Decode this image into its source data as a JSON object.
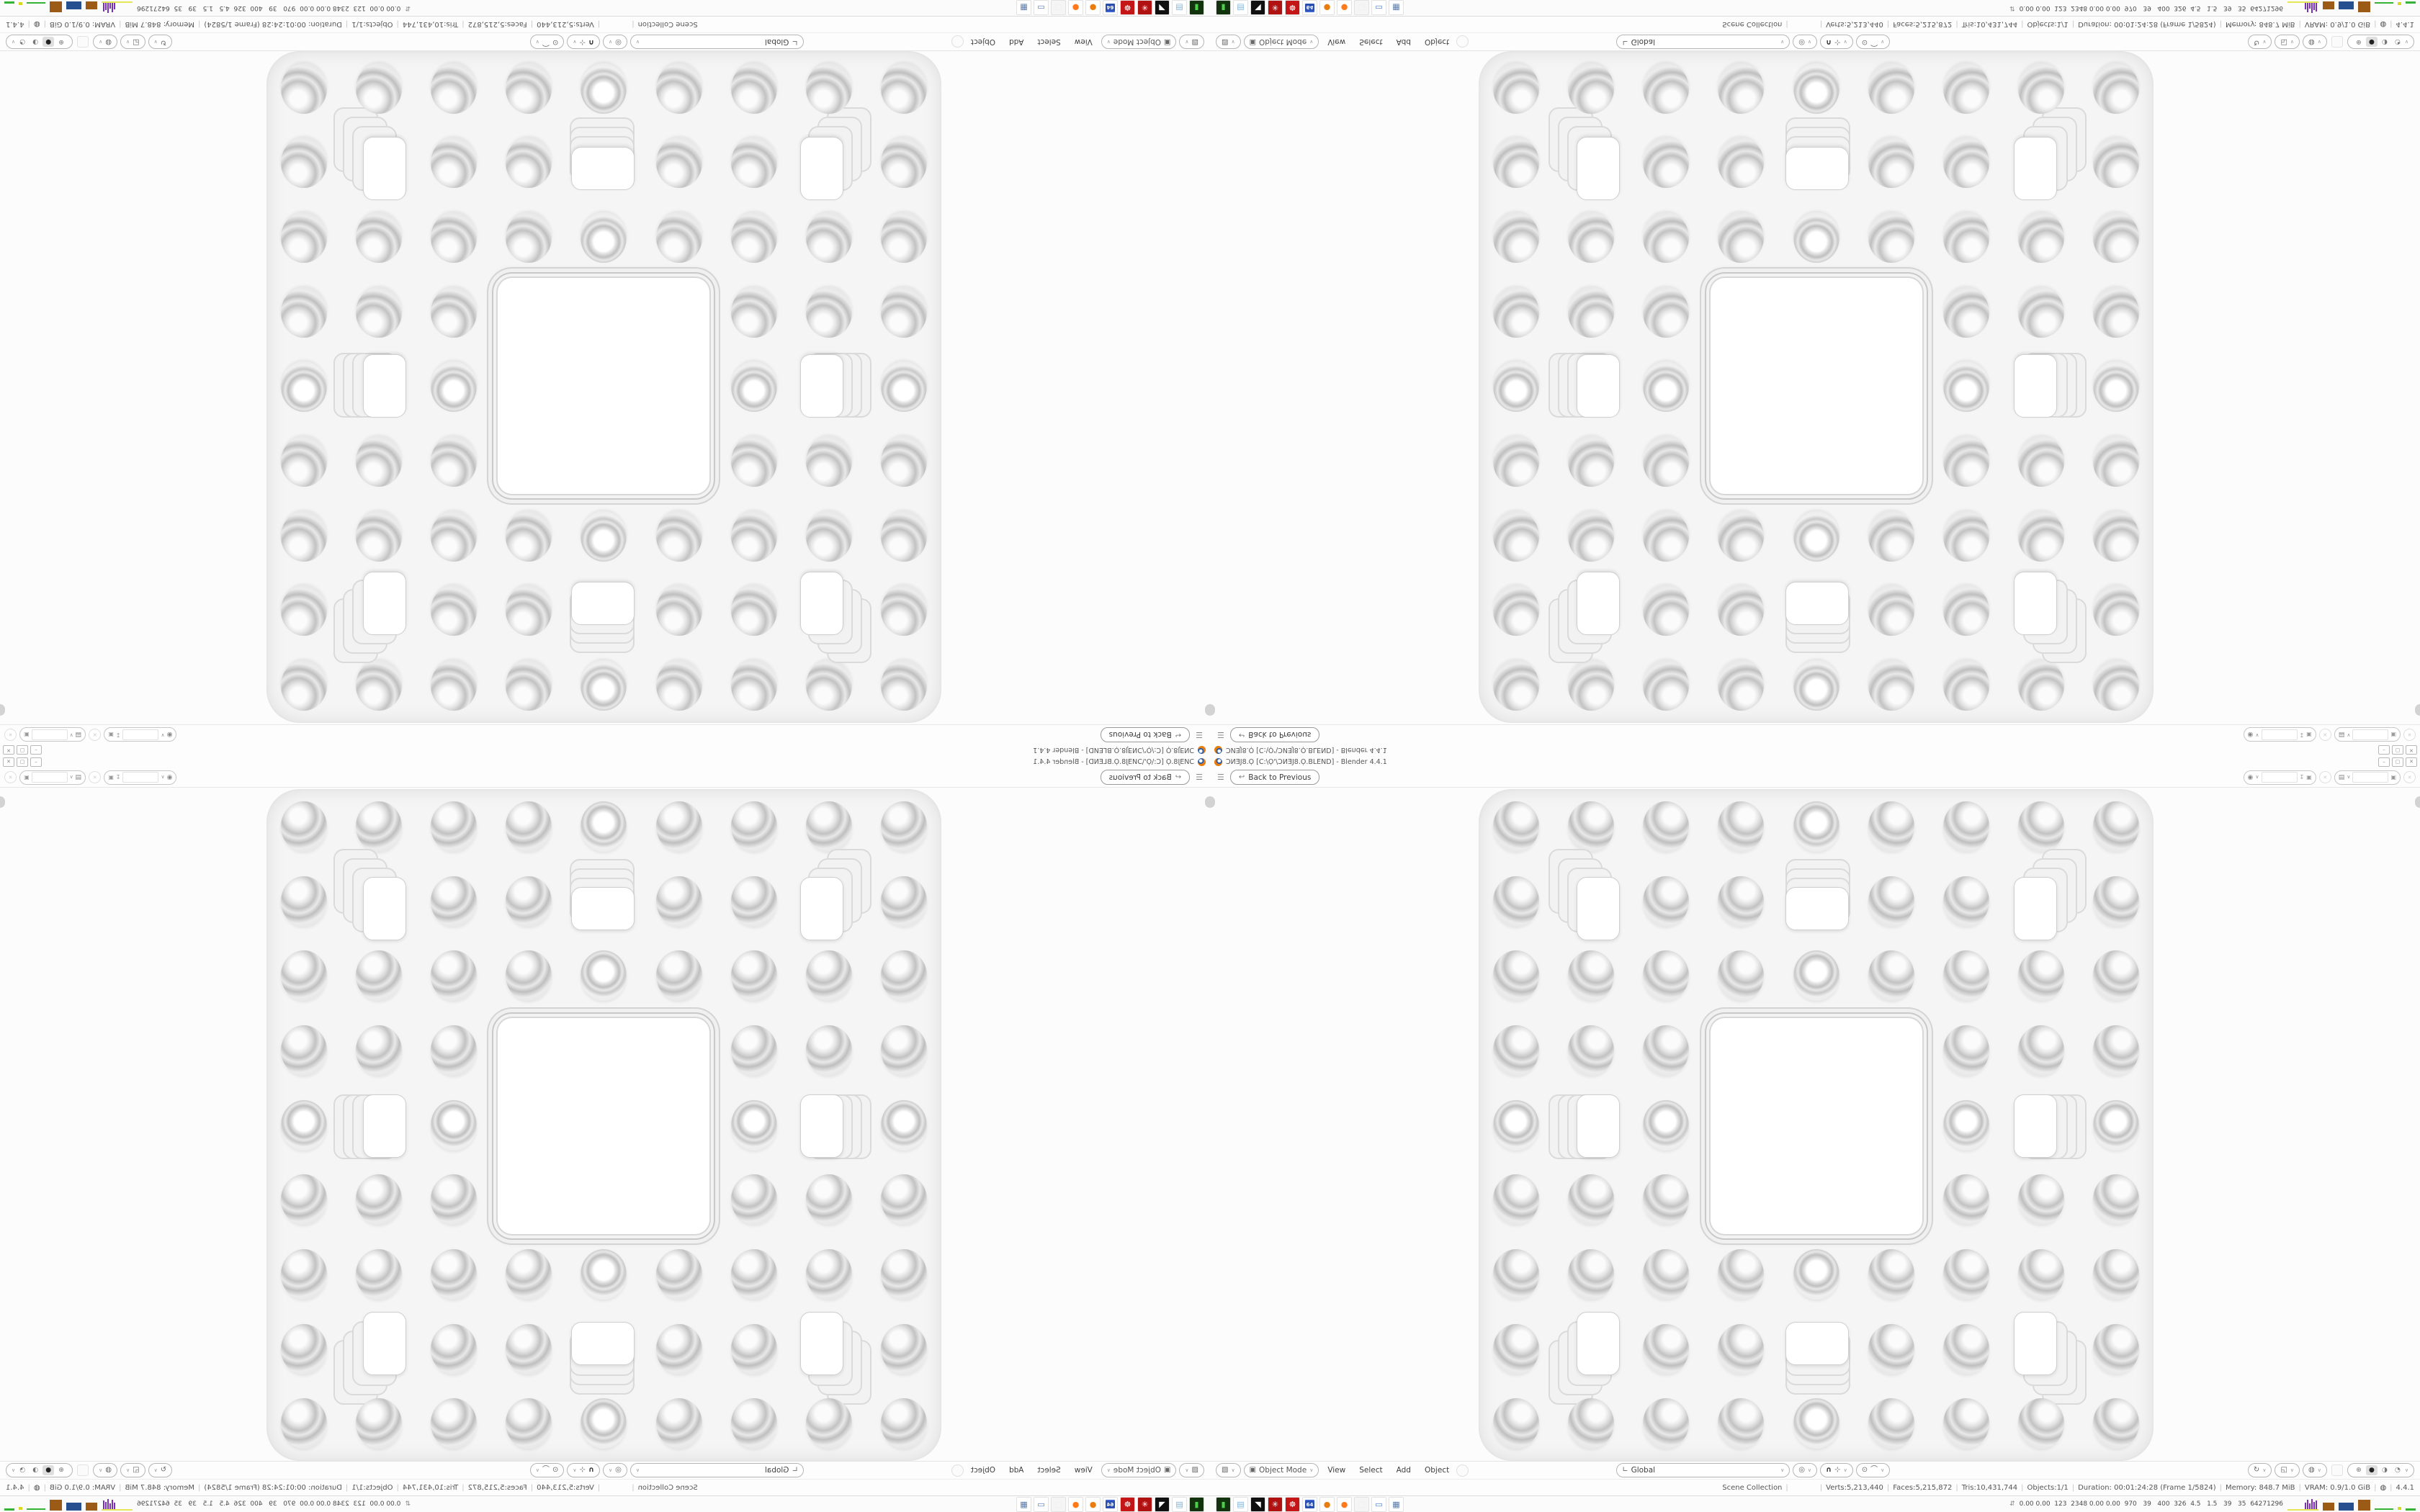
{
  "desktop": {
    "titlebar": {
      "title": "ƆИƎJ8.Ọ [C:\\Ọ'\\ƆИƎJ8.Ọ.BLEND] - Blender 4.4.1",
      "minimize_glyph": "–",
      "restore_glyph": "▢",
      "close_glyph": "✕"
    },
    "topbar": {
      "menu_glyph": "☰",
      "back_icon_glyph": "↩",
      "back_button": "Back to Previous",
      "scene_selector": {
        "icon_glyph": "◉",
        "chevron": "∨",
        "value": "",
        "pin_glyph": "↧",
        "copy_glyph": "▣",
        "clear_glyph": "✕"
      },
      "view_layer_selector": {
        "icon_glyph": "▤",
        "chevron": "∨",
        "value": "",
        "copy_glyph": "▣",
        "clear_glyph": "✕"
      }
    },
    "viewport_header": {
      "editor_icon_glyph": "▧",
      "mode": {
        "icon_glyph": "▣",
        "label": "Object Mode",
        "chevron": "∨"
      },
      "menus": [
        "View",
        "Select",
        "Add",
        "Object"
      ],
      "orientation": {
        "icon_glyph": "∟",
        "label": "Global",
        "chevron": "∨"
      },
      "snap_circle_glyph": "◎",
      "magnet_glyph": "∩",
      "snap_target_glyph": "⊹",
      "prop_edit_glyph": "⊙",
      "falloff_glyph": "⌒",
      "gizmo_glyph": "↻",
      "overlays_glyph": "◱",
      "xray_glyph": "◍",
      "chevron": "∨",
      "shading_modes": [
        {
          "name": "wireframe",
          "glyph": "⊕",
          "active": false
        },
        {
          "name": "solid",
          "glyph": "●",
          "active": true
        },
        {
          "name": "material-preview",
          "glyph": "◑",
          "active": false
        },
        {
          "name": "rendered",
          "glyph": "◔",
          "active": false
        }
      ]
    },
    "statusbar": {
      "segments": [
        "Scene Collection",
        "",
        "Verts:5,213,440",
        "Faces:5,215,872",
        "Tris:10,431,744",
        "Objects:1/1",
        "Duration: 00:01:24:28 (Frame 1/5824)",
        "Memory: 848.7 MiB",
        "VRAM: 0.9/1.0 GiB"
      ],
      "globe_glyph": "◍",
      "version": "4.4.1"
    },
    "taskbar": {
      "icons": [
        {
          "name": "system-monitor-icon",
          "bg": "#13330f",
          "fg": "#4cd04c",
          "glyph": "▮"
        },
        {
          "name": "notepad-icon",
          "bg": "#ffffff",
          "fg": "#7fb2d9",
          "glyph": "▤"
        },
        {
          "name": "media-player-icon",
          "bg": "#101010",
          "fg": "#ffffff",
          "glyph": "◥"
        },
        {
          "name": "red-mandala-icon",
          "bg": "#b01212",
          "fg": "#ffffff",
          "glyph": "✳"
        },
        {
          "name": "red-gear-icon",
          "bg": "#c41616",
          "fg": "#ffffff",
          "glyph": "☸"
        },
        {
          "name": "floppy-64-icon",
          "bg": "#ffffff",
          "fg": "#ffffff",
          "glyph": "64",
          "chip": true
        },
        {
          "name": "blender-app-icon",
          "bg": "#ffffff",
          "fg": "#e87d0d",
          "glyph": "●"
        },
        {
          "name": "firefox-icon",
          "bg": "#ffffff",
          "fg": "#ff7a1a",
          "glyph": "●"
        },
        {
          "name": "ghost-app-icon",
          "bg": "#f5f5f5",
          "fg": "#ededed",
          "glyph": "▢"
        },
        {
          "name": "display-settings-icon",
          "bg": "#ffffff",
          "fg": "#4d7bc0",
          "glyph": "▭"
        },
        {
          "name": "calculator-icon",
          "bg": "#ffffff",
          "fg": "#5577aa",
          "glyph": "▦"
        }
      ],
      "monitor": {
        "chevron": "⇵",
        "readings": "0.00 0.00  123  2348 0.00 0.00  970   39   400  326  4.5   1.5   39   35  64271296"
      }
    },
    "sponge": {
      "description": "menger-sponge-front-view",
      "grid": 9,
      "big_hole_cell_range": [
        3,
        5
      ],
      "medium_hole_cells": [
        [
          1,
          1
        ],
        [
          4,
          1
        ],
        [
          7,
          1
        ],
        [
          1,
          4
        ],
        [
          7,
          4
        ],
        [
          1,
          7
        ],
        [
          4,
          7
        ],
        [
          7,
          7
        ]
      ],
      "face_color": "#f5f5f6",
      "ring_colors": [
        "#ffffff",
        "#e3e3e3",
        "#c2c2c2",
        "#bfbfbf"
      ]
    }
  }
}
